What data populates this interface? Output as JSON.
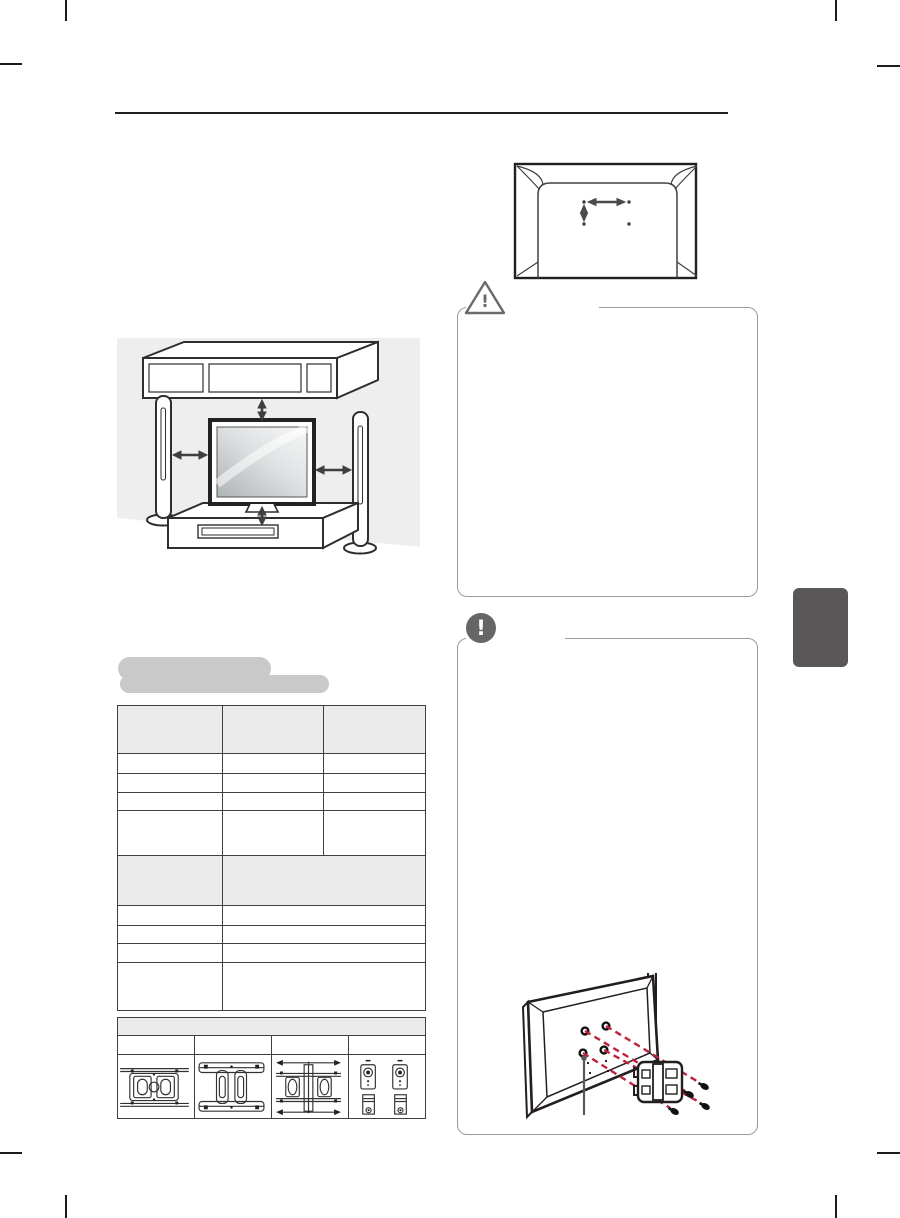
{
  "colors": {
    "page_bg": "#ffffff",
    "rule": "#231f20",
    "table_border": "#3f3f3f",
    "table_header_fill": "#ebebeb",
    "highlight_fill": "#c9c9c9",
    "box_border": "#9b9b9b",
    "icon_gray": "#6a6a6a",
    "note_icon_fill": "#666666",
    "accent_red": "#c2203c",
    "side_tab_fill": "#595757",
    "wall_fill": "#efeeee",
    "line_art": "#2e2e2e"
  },
  "caution_box": {
    "icon_glyph": "!"
  },
  "note_box": {
    "icon_glyph": "!"
  },
  "spec_table": {
    "columns": 3,
    "body_rows": 9,
    "all_cells_blank": true
  },
  "accessory_table": {
    "columns": 4,
    "rows": 3,
    "all_cells_blank": true
  }
}
